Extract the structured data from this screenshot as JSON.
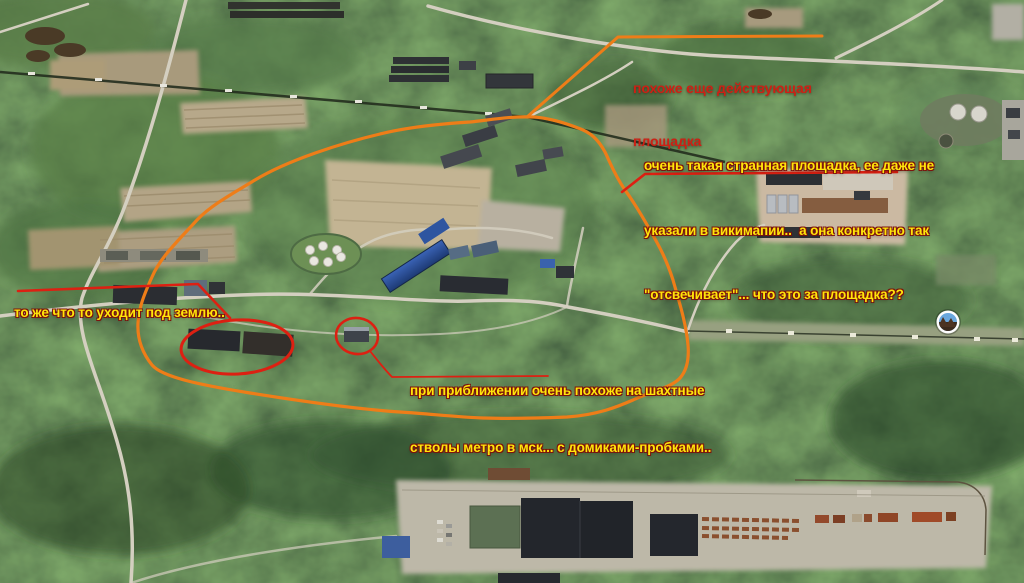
{
  "colors": {
    "annotation_orange": "#ee7d18",
    "annotation_red": "#dd2012",
    "annotation_yellow": "#ffe60a",
    "yellow_outline": "#7c120c",
    "red_text": "#cd2014"
  },
  "annotations": {
    "note_top": {
      "line1": "похоже еще действующая",
      "line2": "площадка"
    },
    "note_right": {
      "line1": "очень такая странная площадка, ее даже не",
      "line2": "указали в викимапии..  а она конкретно так",
      "line3": "\"отсвечивает\"... что это за площадка??"
    },
    "note_left": {
      "line1": "то же что то уходит под землю.."
    },
    "note_center": {
      "line1": "при приближении очень похоже на шахтные",
      "line2": "стволы метро в мск... с домиками-пробками.."
    }
  },
  "map": {
    "icons": {
      "photo_marker": "photo-sphere-marker"
    }
  }
}
